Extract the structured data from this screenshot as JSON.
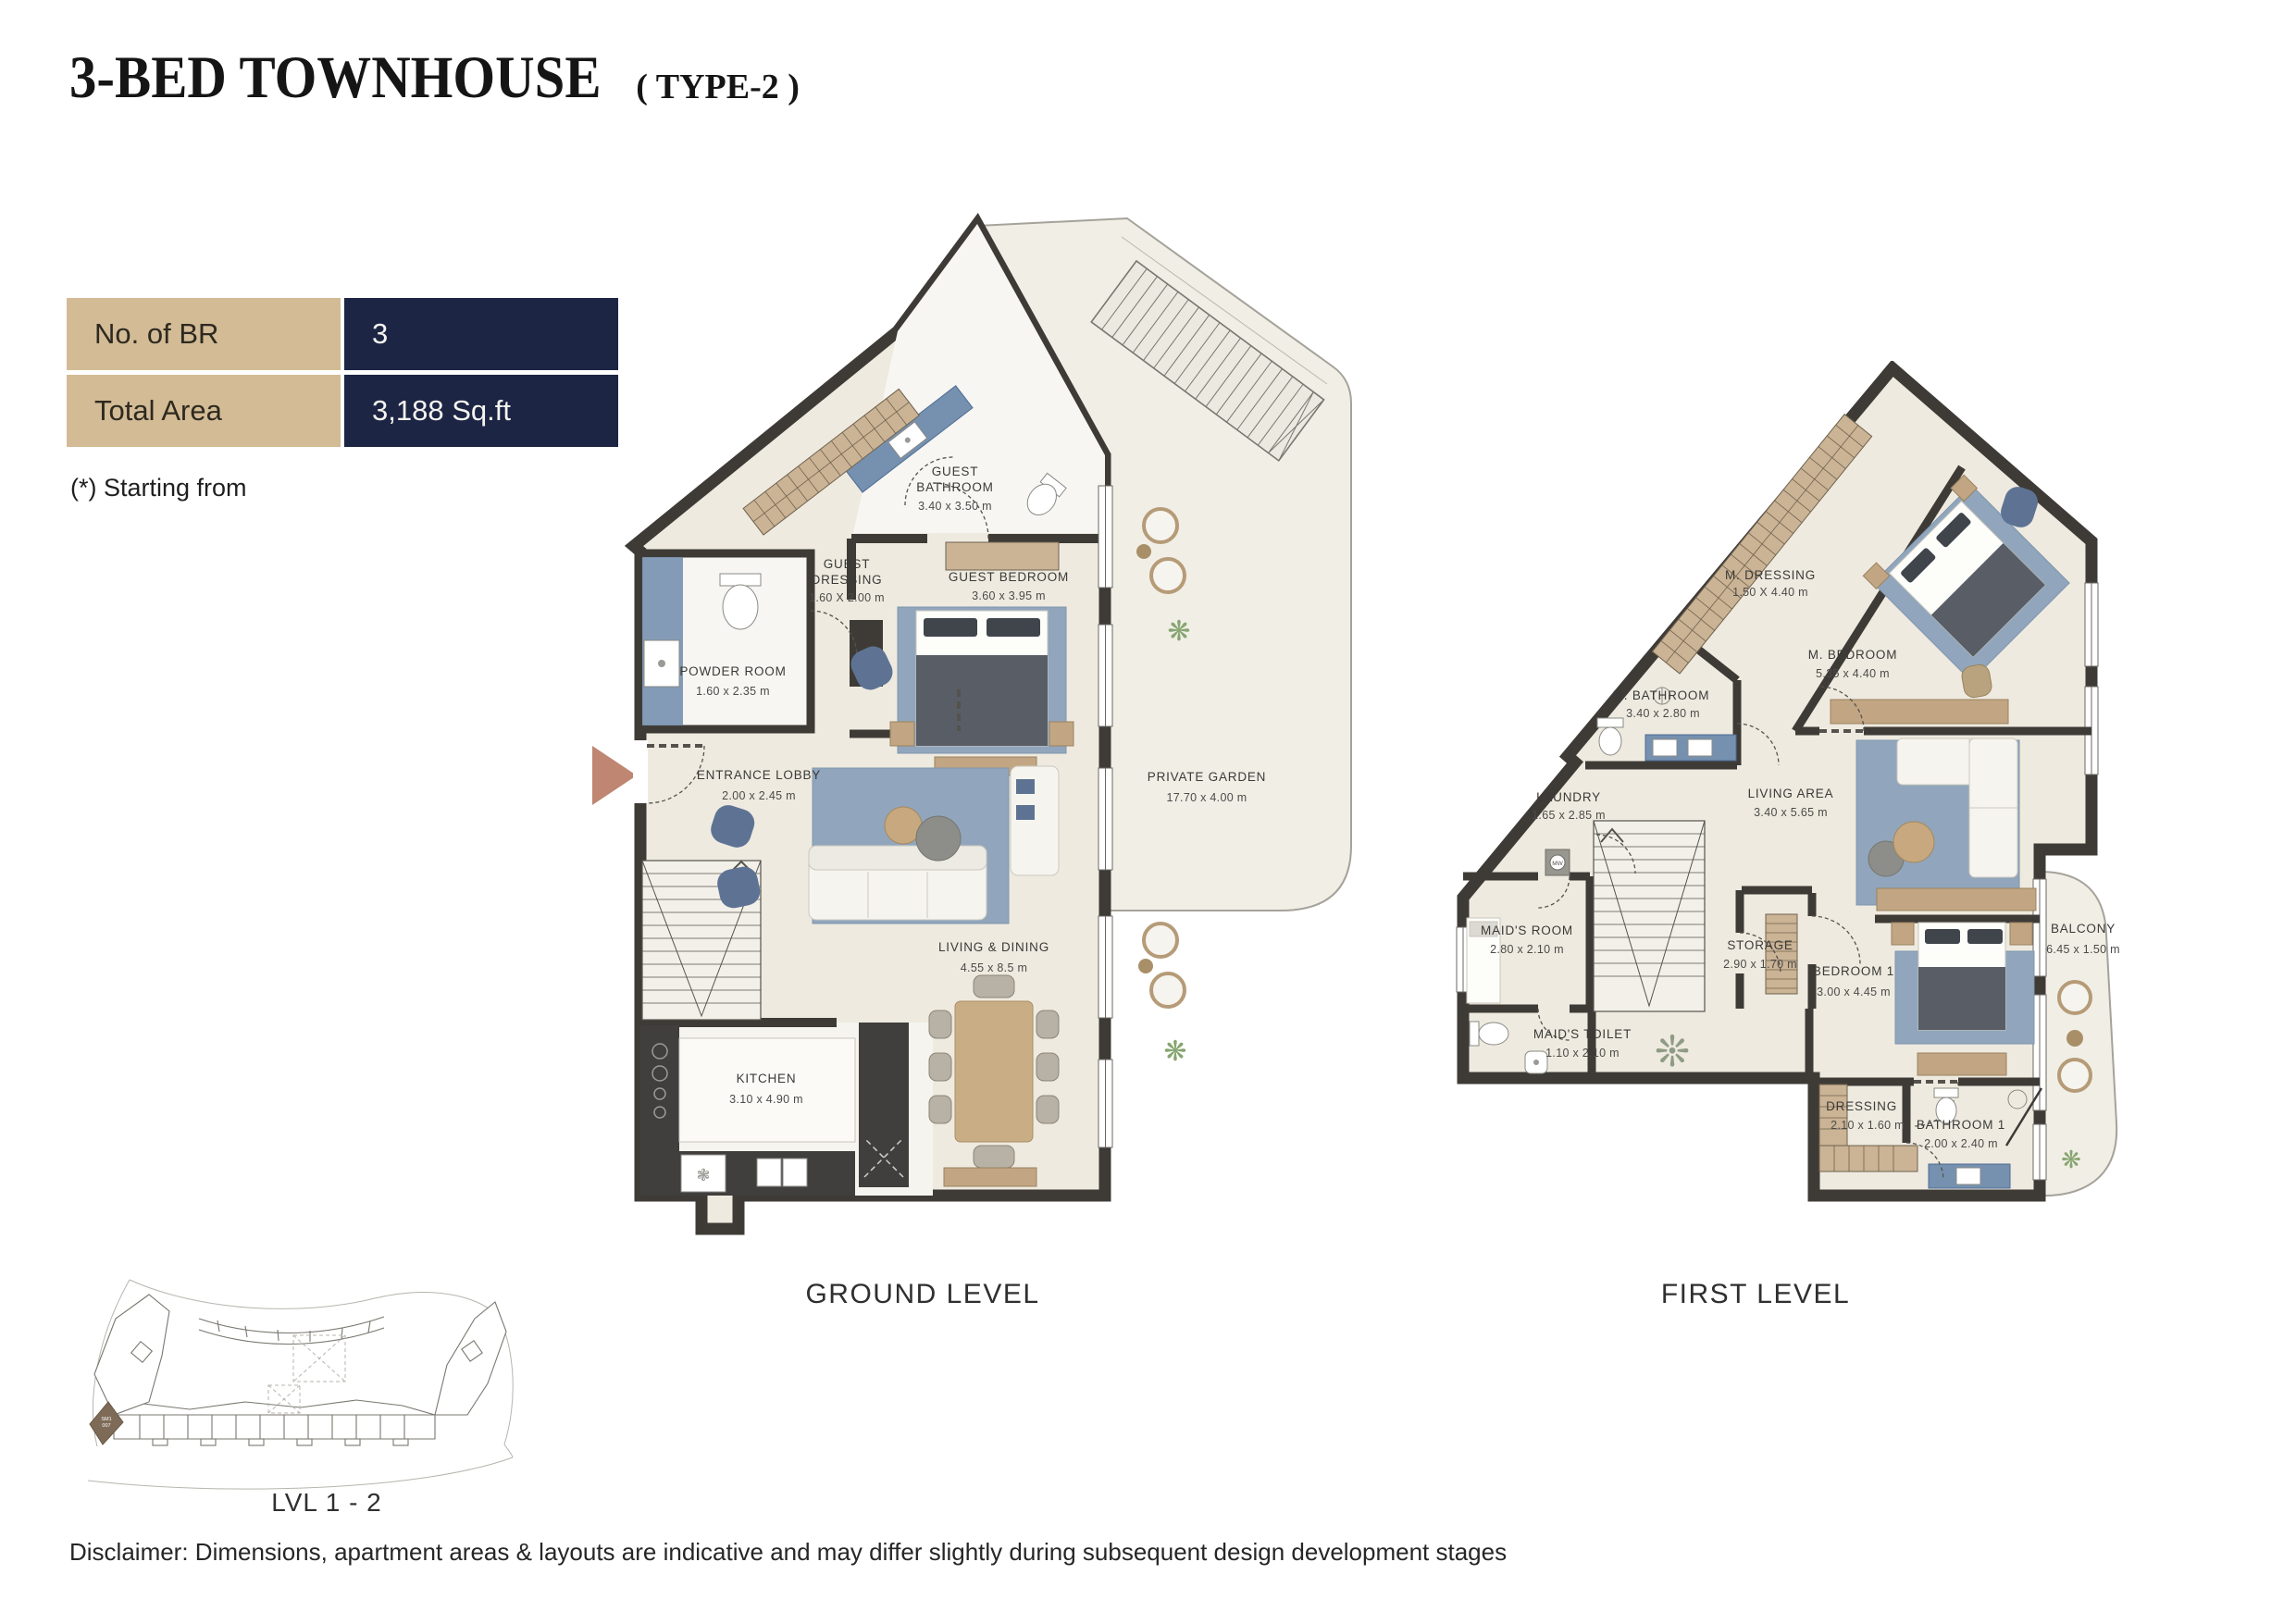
{
  "title": {
    "main": "3-BED TOWNHOUSE",
    "sub": "( TYPE-2 )"
  },
  "specs": {
    "rows": [
      {
        "label": "No. of BR",
        "value": "3"
      },
      {
        "label": "Total Area",
        "value": "3,188 Sq.ft"
      }
    ],
    "note": "(*) Starting from"
  },
  "colors": {
    "tan_cell": "#d2bb95",
    "navy_cell": "#1d2544",
    "wall": "#3e3b37",
    "entry_arrow": "#bf8672",
    "rug_blue": "#91a6bc",
    "wood": "#c2a683",
    "tile_blue": "#7691af"
  },
  "ground": {
    "caption": "GROUND LEVEL",
    "rooms": [
      {
        "line1": "GUEST",
        "line2": "BATHROOM",
        "dims": "3.40 x 3.50 m"
      },
      {
        "line1": "GUEST",
        "line2": "DRESSING",
        "dims": "1.60 X 2.00 m"
      },
      {
        "line1": "GUEST BEDROOM",
        "dims": "3.60 x 3.95 m"
      },
      {
        "line1": "POWDER ROOM",
        "dims": "1.60 x 2.35 m"
      },
      {
        "line1": "ENTRANCE LOBBY",
        "dims": "2.00 x 2.45 m"
      },
      {
        "line1": "LIVING & DINING",
        "dims": "4.55 x 8.5 m"
      },
      {
        "line1": "KITCHEN",
        "dims": "3.10 x 4.90 m"
      },
      {
        "line1": "PRIVATE GARDEN",
        "dims": "17.70 x 4.00 m"
      }
    ]
  },
  "first": {
    "caption": "FIRST LEVEL",
    "laundry_appliance": "MW",
    "rooms": [
      {
        "line1": "M. DRESSING",
        "dims": "1.50 X 4.40 m"
      },
      {
        "line1": "M. BEDROOM",
        "dims": "5.35 x 4.40 m"
      },
      {
        "line1": "M. BATHROOM",
        "dims": "3.40 x 2.80 m"
      },
      {
        "line1": "LAUNDRY",
        "dims": "1.65 x 2.85 m"
      },
      {
        "line1": "LIVING AREA",
        "dims": "3.40 x 5.65 m"
      },
      {
        "line1": "MAID'S ROOM",
        "dims": "2.80 x 2.10 m"
      },
      {
        "line1": "STORAGE",
        "dims": "2.90 x 1.70 m"
      },
      {
        "line1": "MAID'S TOILET",
        "dims": "1.10 x 2.10 m"
      },
      {
        "line1": "BEDROOM 1",
        "dims": "3.00 x 4.45 m"
      },
      {
        "line1": "BALCONY",
        "dims": "6.45 x 1.50 m"
      },
      {
        "line1": "DRESSING 1",
        "dims": "2.10 x 1.60 m"
      },
      {
        "line1": "BATHROOM 1",
        "dims": "2.00 x 2.40 m"
      }
    ]
  },
  "keyplan": {
    "label": "LVL 1 - 2",
    "unit_line1": "SM1",
    "unit_line2": "007"
  },
  "disclaimer": "Disclaimer: Dimensions, apartment areas & layouts are indicative and may differ slightly during subsequent design development stages"
}
